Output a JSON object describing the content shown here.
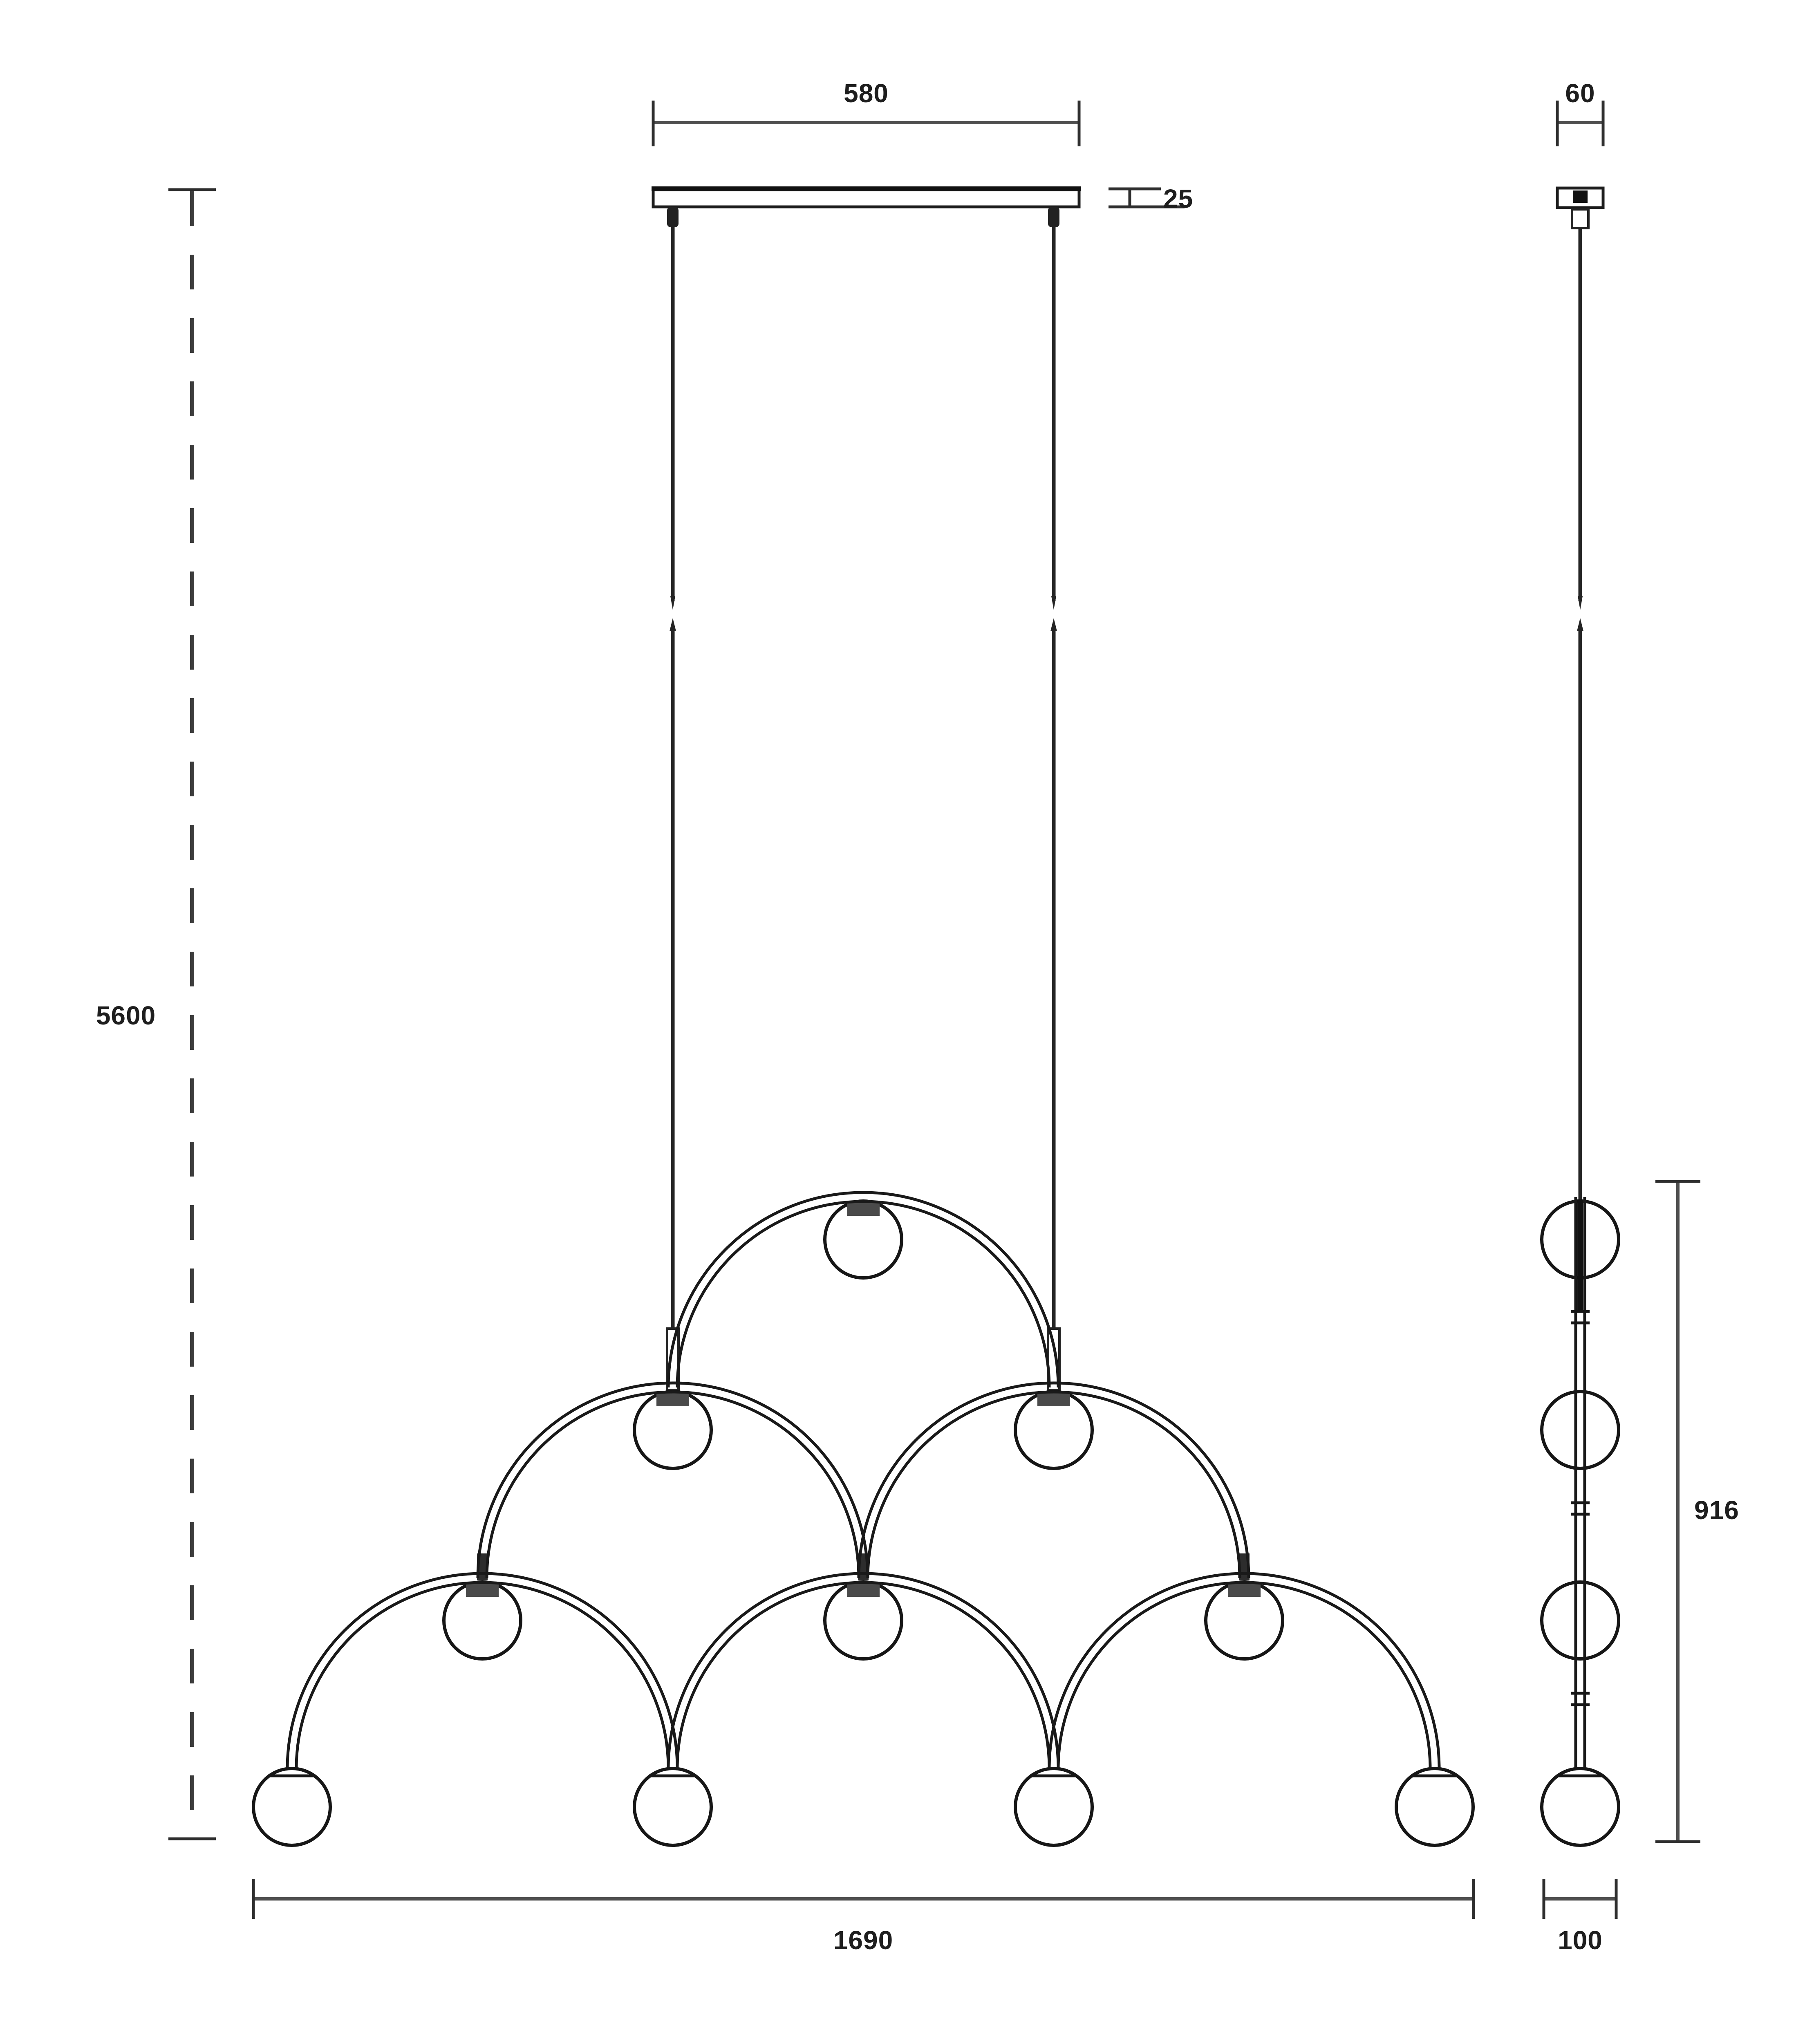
{
  "labels": {
    "canopy_width": "580",
    "canopy_height": "25",
    "canopy_depth": "60",
    "max_suspension": "5600",
    "fixture_width": "1690",
    "fixture_height": "916",
    "fixture_depth": "100"
  },
  "colors": {
    "background": "#ffffff",
    "structure": "#191919",
    "dimension_lines": "#4f4f4f",
    "text": "#1e1e1e"
  },
  "figure": {
    "front_sphere_count": 10,
    "side_sphere_count": 4,
    "arch_count": 6,
    "suspension_wire_count": 2
  }
}
